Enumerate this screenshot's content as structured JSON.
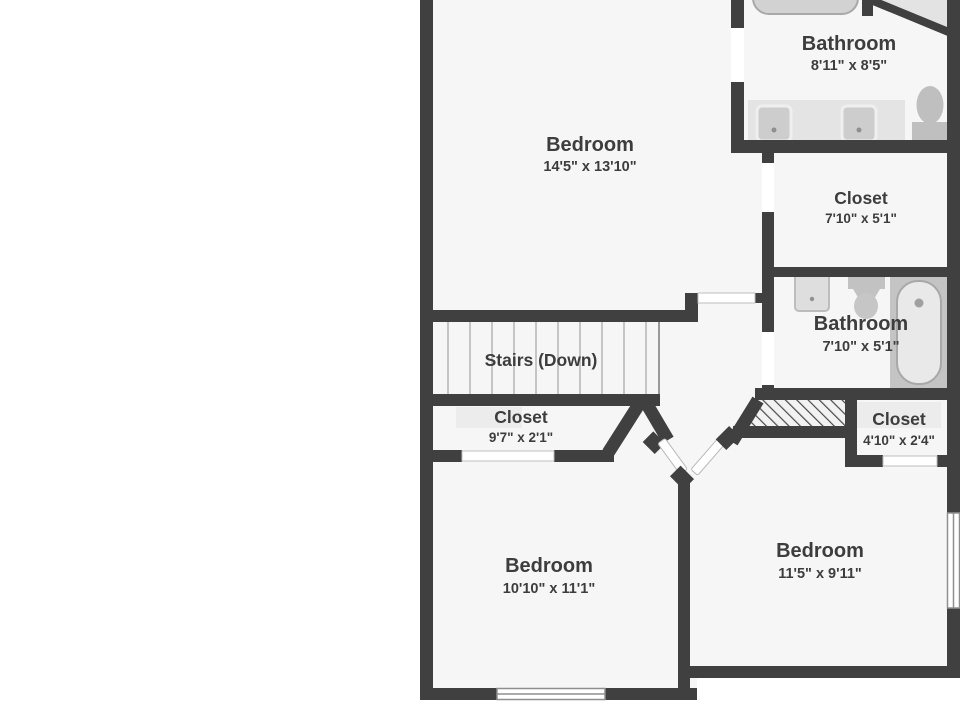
{
  "floorplan": {
    "rooms": {
      "master_bedroom": {
        "name": "Bedroom",
        "dims": "14'5\" x 13'10\""
      },
      "master_bathroom": {
        "name": "Bathroom",
        "dims": "8'11\" x 8'5\""
      },
      "master_closet": {
        "name": "Closet",
        "dims": "7'10\" x 5'1\""
      },
      "hall_bathroom": {
        "name": "Bathroom",
        "dims": "7'10\" x 5'1\""
      },
      "stairs": {
        "name": "Stairs (Down)"
      },
      "hall_closet": {
        "name": "Closet",
        "dims": "9'7\" x 2'1\""
      },
      "bedroom2_closet": {
        "name": "Closet",
        "dims": "4'10\" x 2'4\""
      },
      "bedroom_2": {
        "name": "Bedroom",
        "dims": "10'10\" x 11'1\""
      },
      "bedroom_3": {
        "name": "Bedroom",
        "dims": "11'5\" x 9'11\""
      }
    },
    "colors": {
      "wall": "#404040",
      "floor": "#f6f6f6",
      "background": "#ffffff",
      "text": "#3d3d3d"
    }
  }
}
